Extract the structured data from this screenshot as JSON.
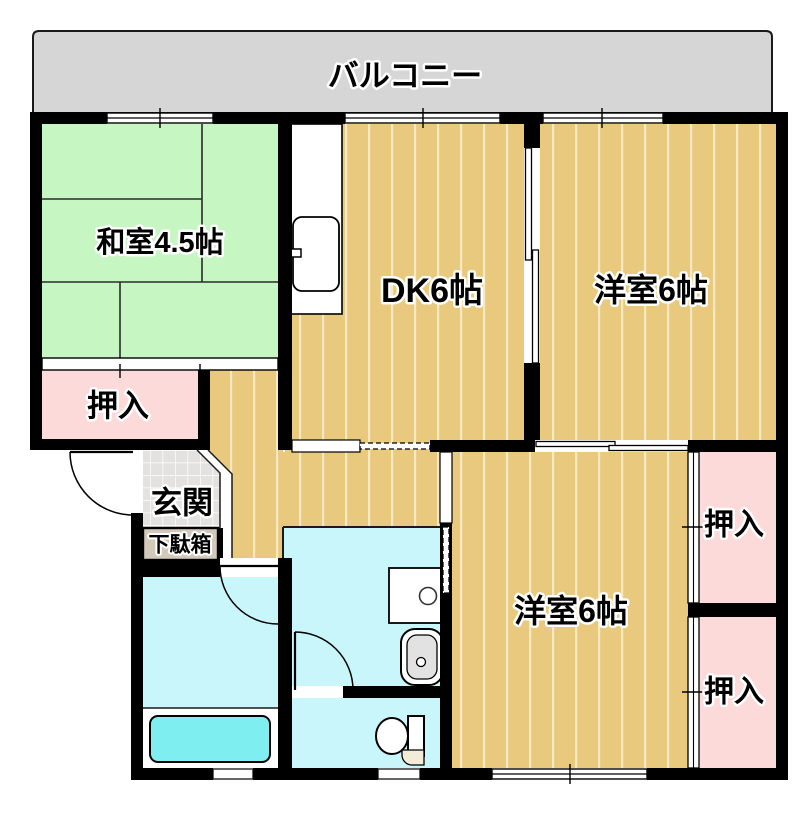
{
  "floorplan": {
    "balcony": {
      "label": "バルコニー"
    },
    "rooms": {
      "washitsu": {
        "label": "和室4.5帖"
      },
      "dk": {
        "label": "DK6帖"
      },
      "yoshitsu_ne": {
        "label": "洋室6帖"
      },
      "yoshitsu_se": {
        "label": "洋室6帖"
      },
      "oshiire_nw": {
        "label": "押入"
      },
      "oshiire_e_upper": {
        "label": "押入"
      },
      "oshiire_e_lower": {
        "label": "押入"
      },
      "genkan": {
        "label": "玄関"
      },
      "getabako": {
        "label": "下駄箱"
      }
    },
    "colors": {
      "wall": "#000000",
      "balcony": "#d6d6d6",
      "tatami_green": "#c6f6c2",
      "wood": "#e9c97d",
      "wood_stripe": "#f7e9c2",
      "closet_pink": "#fcdada",
      "wet_cyan": "#c9f6fb",
      "bathtub_cyan": "#7eeef0",
      "genkan_tile": "#e4e2e0",
      "getabako_fill": "#d3c9ba",
      "toilet_lid_beige": "#f3ecd9"
    }
  }
}
